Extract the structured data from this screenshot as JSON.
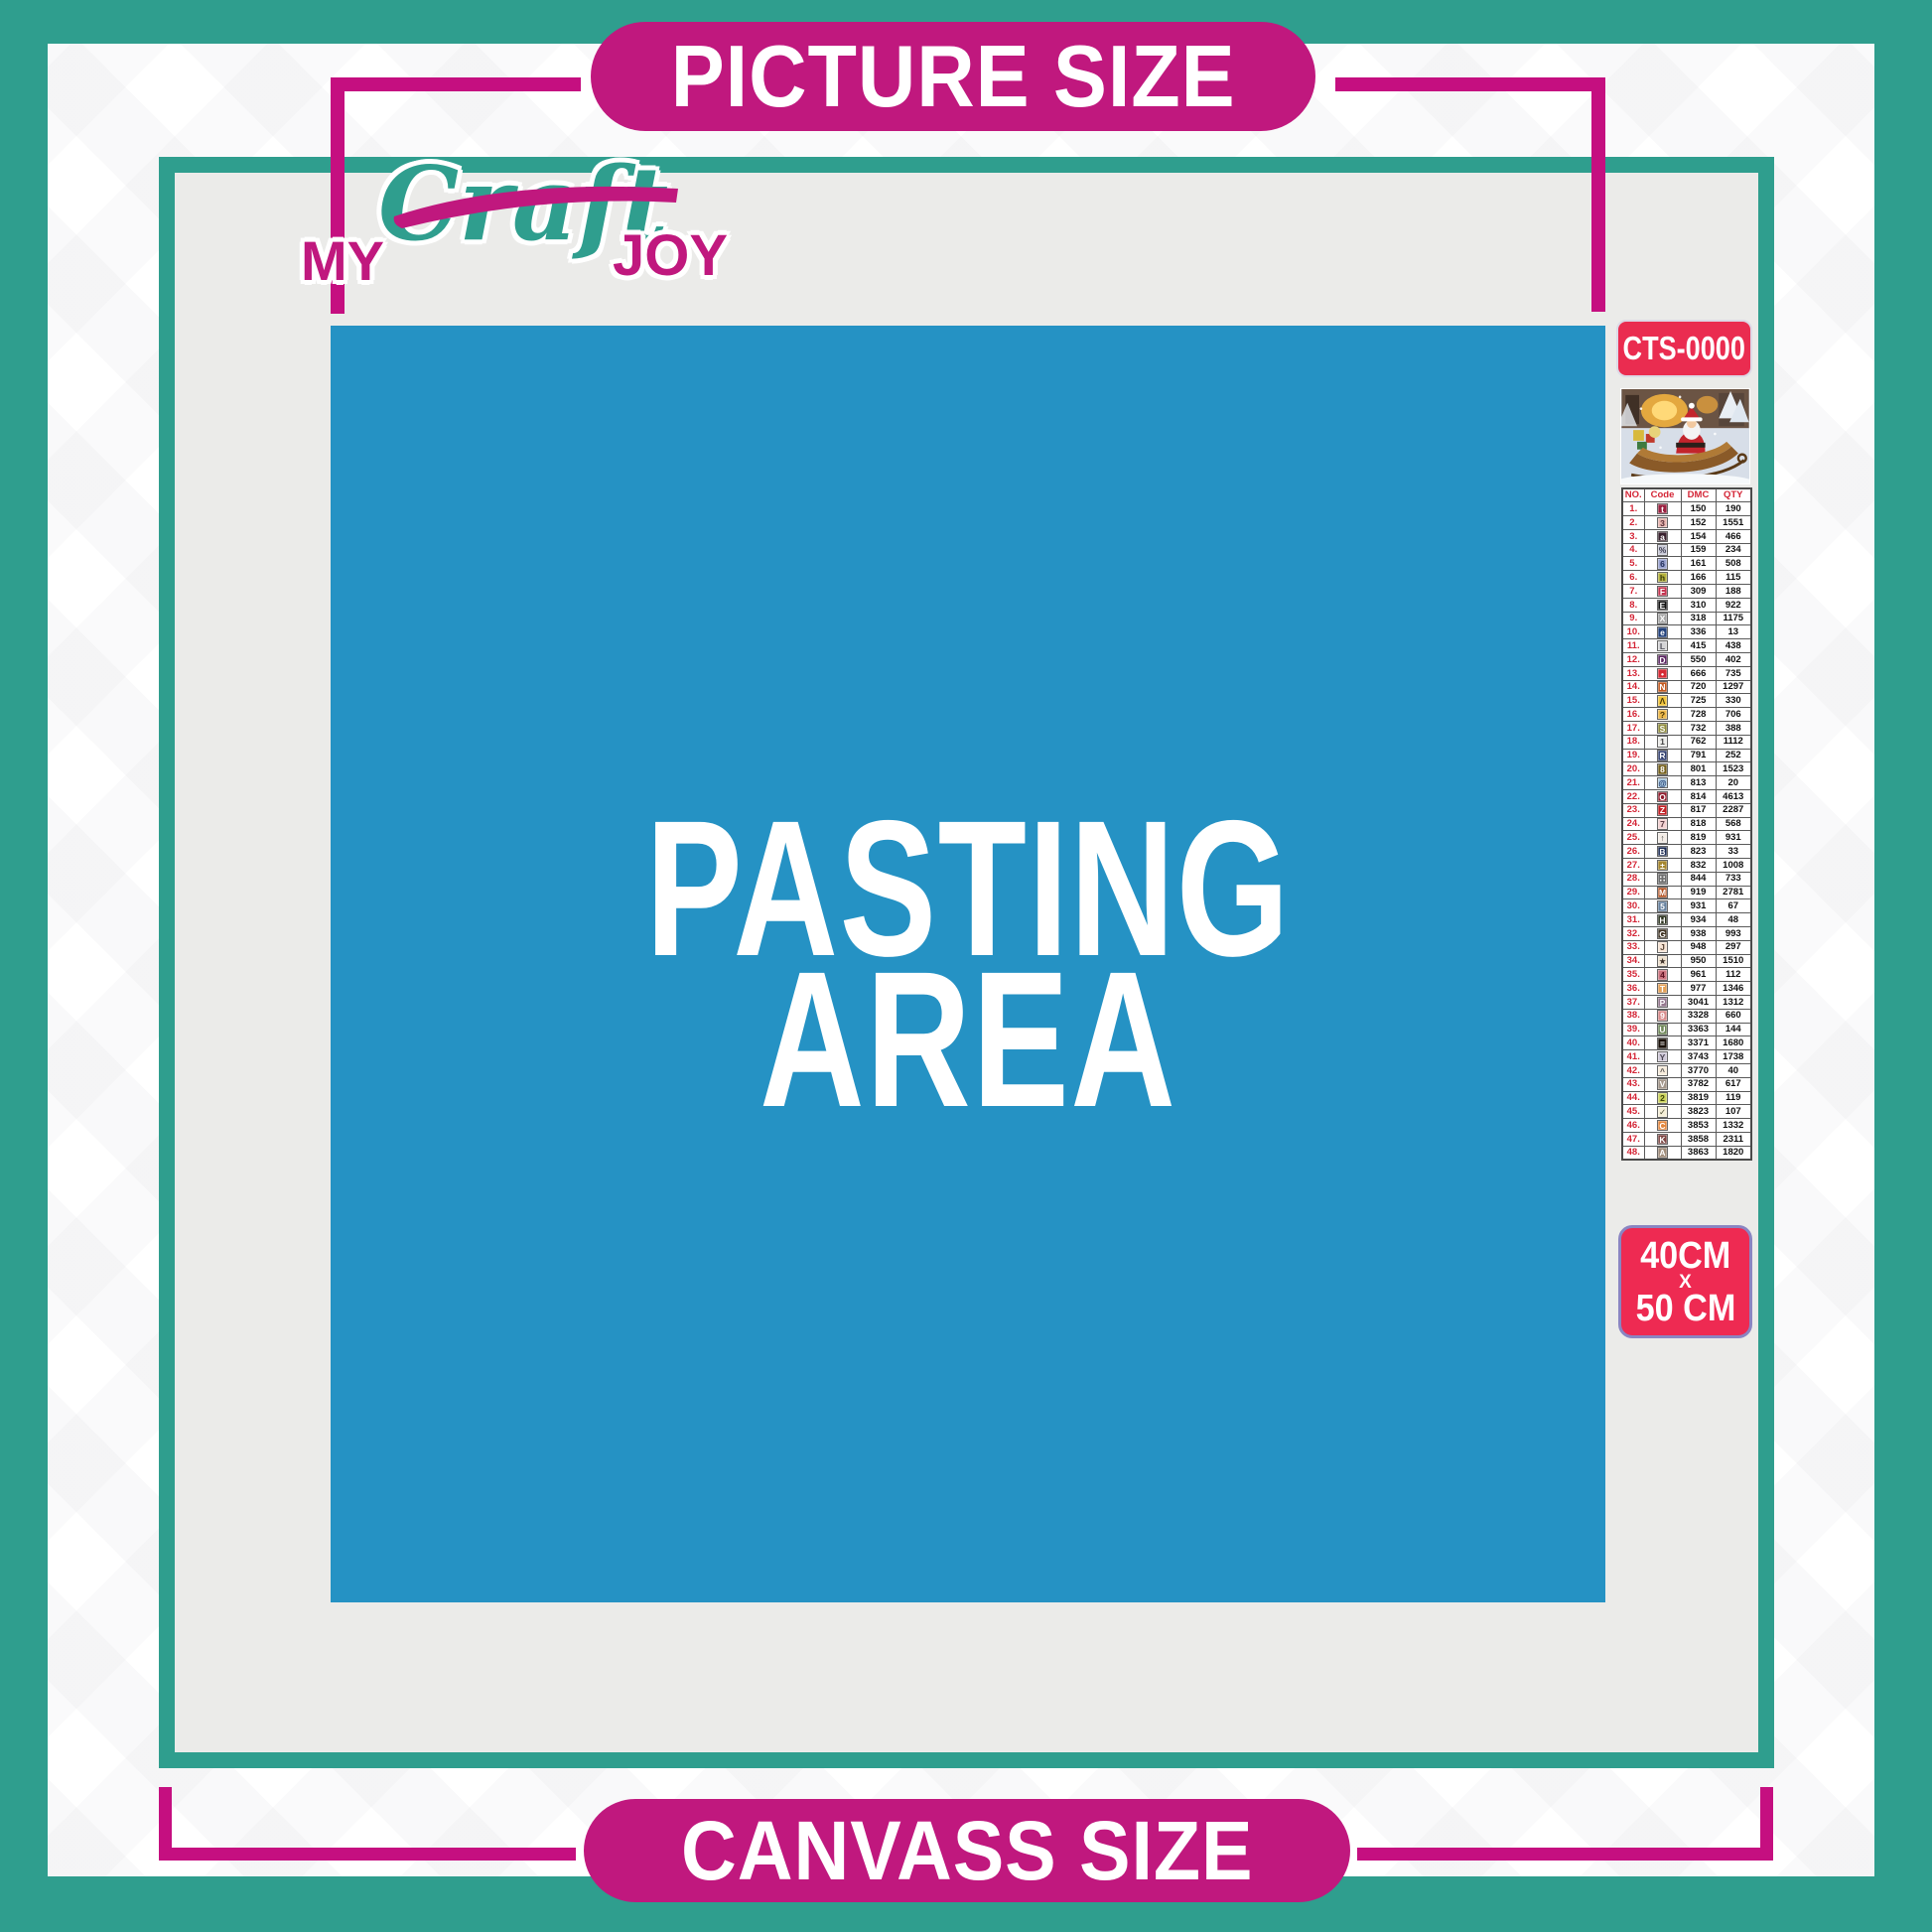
{
  "banners": {
    "top": "PICTURE SIZE",
    "bottom": "CANVASS SIZE"
  },
  "logo": {
    "word1": "MY",
    "word2": "Craft",
    "word3": "JOY"
  },
  "pasting_area": {
    "line1": "PASTING",
    "line2": "AREA"
  },
  "product": {
    "code": "CTS-0000",
    "thumbnail_alt": "Santa Claus riding a gift-filled sleigh in a snowy Christmas scene",
    "size_line1": "40CM",
    "size_line2": "X",
    "size_line3": "50 CM"
  },
  "colors": {
    "teal": "#2f9e8e",
    "magenta": "#c0187e",
    "blue": "#2592c4",
    "badge_red": "#ea2c50",
    "board_gray": "#ebebe9"
  },
  "color_table": {
    "headers": [
      "NO.",
      "Code",
      "DMC",
      "QTY"
    ],
    "rows": [
      {
        "no": "1.",
        "symbol": "t",
        "chip_bg": "#9a2140",
        "chip_fg": "#ffffff",
        "dmc": "150",
        "qty": "190"
      },
      {
        "no": "2.",
        "symbol": "3",
        "chip_bg": "#e7b5af",
        "chip_fg": "#5a3038",
        "dmc": "152",
        "qty": "1551"
      },
      {
        "no": "3.",
        "symbol": "a",
        "chip_bg": "#39212e",
        "chip_fg": "#ffffff",
        "dmc": "154",
        "qty": "466"
      },
      {
        "no": "4.",
        "symbol": "%",
        "chip_bg": "#c8c9d6",
        "chip_fg": "#3c3c50",
        "dmc": "159",
        "qty": "234"
      },
      {
        "no": "5.",
        "symbol": "6",
        "chip_bg": "#9aa3cf",
        "chip_fg": "#1e2a56",
        "dmc": "161",
        "qty": "508"
      },
      {
        "no": "6.",
        "symbol": "h",
        "chip_bg": "#b4b13c",
        "chip_fg": "#383a0e",
        "dmc": "166",
        "qty": "115"
      },
      {
        "no": "7.",
        "symbol": "F",
        "chip_bg": "#c43450",
        "chip_fg": "#ffffff",
        "dmc": "309",
        "qty": "188"
      },
      {
        "no": "8.",
        "symbol": "E",
        "chip_bg": "#111111",
        "chip_fg": "#ffffff",
        "dmc": "310",
        "qty": "922"
      },
      {
        "no": "9.",
        "symbol": "X",
        "chip_bg": "#a6a6a6",
        "chip_fg": "#ffffff",
        "dmc": "318",
        "qty": "1175"
      },
      {
        "no": "10.",
        "symbol": "e",
        "chip_bg": "#23427c",
        "chip_fg": "#ffffff",
        "dmc": "336",
        "qty": "13"
      },
      {
        "no": "11.",
        "symbol": "L",
        "chip_bg": "#d4d4d6",
        "chip_fg": "#55555f",
        "dmc": "415",
        "qty": "438"
      },
      {
        "no": "12.",
        "symbol": "D",
        "chip_bg": "#5a2460",
        "chip_fg": "#ffffff",
        "dmc": "550",
        "qty": "402"
      },
      {
        "no": "13.",
        "symbol": "•",
        "chip_bg": "#d62b35",
        "chip_fg": "#ffffff",
        "dmc": "666",
        "qty": "735"
      },
      {
        "no": "14.",
        "symbol": "N",
        "chip_bg": "#c2591f",
        "chip_fg": "#ffffff",
        "dmc": "720",
        "qty": "1297"
      },
      {
        "no": "15.",
        "symbol": "Λ",
        "chip_bg": "#f2c63f",
        "chip_fg": "#4a3a08",
        "dmc": "725",
        "qty": "330"
      },
      {
        "no": "16.",
        "symbol": "?",
        "chip_bg": "#ecb84b",
        "chip_fg": "#4a3508",
        "dmc": "728",
        "qty": "706"
      },
      {
        "no": "17.",
        "symbol": "S",
        "chip_bg": "#8f8b3c",
        "chip_fg": "#ffffff",
        "dmc": "732",
        "qty": "388"
      },
      {
        "no": "18.",
        "symbol": "1",
        "chip_bg": "#ededea",
        "chip_fg": "#444444",
        "dmc": "762",
        "qty": "1112"
      },
      {
        "no": "19.",
        "symbol": "R",
        "chip_bg": "#32406f",
        "chip_fg": "#ffffff",
        "dmc": "791",
        "qty": "252"
      },
      {
        "no": "20.",
        "symbol": "8",
        "chip_bg": "#75601c",
        "chip_fg": "#ffffff",
        "dmc": "801",
        "qty": "1523"
      },
      {
        "no": "21.",
        "symbol": "@",
        "chip_bg": "#a9c6dd",
        "chip_fg": "#1d3a6e",
        "dmc": "813",
        "qty": "20"
      },
      {
        "no": "22.",
        "symbol": "O",
        "chip_bg": "#8f1b2c",
        "chip_fg": "#ffffff",
        "dmc": "814",
        "qty": "4613"
      },
      {
        "no": "23.",
        "symbol": "Z",
        "chip_bg": "#c02025",
        "chip_fg": "#ffffff",
        "dmc": "817",
        "qty": "2287"
      },
      {
        "no": "24.",
        "symbol": "7",
        "chip_bg": "#f3d2d2",
        "chip_fg": "#5a3a42",
        "dmc": "818",
        "qty": "568"
      },
      {
        "no": "25.",
        "symbol": "↑",
        "chip_bg": "#f3ece6",
        "chip_fg": "#444444",
        "dmc": "819",
        "qty": "931"
      },
      {
        "no": "26.",
        "symbol": "B",
        "chip_bg": "#1b2a52",
        "chip_fg": "#ffffff",
        "dmc": "823",
        "qty": "33"
      },
      {
        "no": "27.",
        "symbol": "±",
        "chip_bg": "#a5862e",
        "chip_fg": "#ffffff",
        "dmc": "832",
        "qty": "1008"
      },
      {
        "no": "28.",
        "symbol": "∷",
        "chip_bg": "#6e6e6e",
        "chip_fg": "#ffffff",
        "dmc": "844",
        "qty": "733"
      },
      {
        "no": "29.",
        "symbol": "M",
        "chip_bg": "#b35222",
        "chip_fg": "#ffffff",
        "dmc": "919",
        "qty": "2781"
      },
      {
        "no": "30.",
        "symbol": "5",
        "chip_bg": "#68829f",
        "chip_fg": "#ffffff",
        "dmc": "931",
        "qty": "67"
      },
      {
        "no": "31.",
        "symbol": "H",
        "chip_bg": "#2c331f",
        "chip_fg": "#ffffff",
        "dmc": "934",
        "qty": "48"
      },
      {
        "no": "32.",
        "symbol": "G",
        "chip_bg": "#3e3222",
        "chip_fg": "#ffffff",
        "dmc": "938",
        "qty": "993"
      },
      {
        "no": "33.",
        "symbol": "J",
        "chip_bg": "#f6e3d4",
        "chip_fg": "#5a4636",
        "dmc": "948",
        "qty": "297"
      },
      {
        "no": "34.",
        "symbol": "★",
        "chip_bg": "#eee0ce",
        "chip_fg": "#3c3028",
        "dmc": "950",
        "qty": "1510"
      },
      {
        "no": "35.",
        "symbol": "4",
        "chip_bg": "#cc7580",
        "chip_fg": "#5c1020",
        "dmc": "961",
        "qty": "112"
      },
      {
        "no": "36.",
        "symbol": "T",
        "chip_bg": "#e2a057",
        "chip_fg": "#ffffff",
        "dmc": "977",
        "qty": "1346"
      },
      {
        "no": "37.",
        "symbol": "P",
        "chip_bg": "#95788f",
        "chip_fg": "#ffffff",
        "dmc": "3041",
        "qty": "1312"
      },
      {
        "no": "38.",
        "symbol": "9",
        "chip_bg": "#d88c8c",
        "chip_fg": "#ffffff",
        "dmc": "3328",
        "qty": "660"
      },
      {
        "no": "39.",
        "symbol": "U",
        "chip_bg": "#70885a",
        "chip_fg": "#ffffff",
        "dmc": "3363",
        "qty": "144"
      },
      {
        "no": "40.",
        "symbol": "=",
        "chip_bg": "#191009",
        "chip_fg": "#ffffff",
        "dmc": "3371",
        "qty": "1680"
      },
      {
        "no": "41.",
        "symbol": "Y",
        "chip_bg": "#cfc9d8",
        "chip_fg": "#4a4452",
        "dmc": "3743",
        "qty": "1738"
      },
      {
        "no": "42.",
        "symbol": "^",
        "chip_bg": "#f7ecdc",
        "chip_fg": "#555555",
        "dmc": "3770",
        "qty": "40"
      },
      {
        "no": "43.",
        "symbol": "V",
        "chip_bg": "#a3968a",
        "chip_fg": "#ffffff",
        "dmc": "3782",
        "qty": "617"
      },
      {
        "no": "44.",
        "symbol": "2",
        "chip_bg": "#ccd35e",
        "chip_fg": "#3c4208",
        "dmc": "3819",
        "qty": "119"
      },
      {
        "no": "45.",
        "symbol": "✓",
        "chip_bg": "#f5efd8",
        "chip_fg": "#4a4a30",
        "dmc": "3823",
        "qty": "107"
      },
      {
        "no": "46.",
        "symbol": "C",
        "chip_bg": "#e3873e",
        "chip_fg": "#ffffff",
        "dmc": "3853",
        "qty": "1332"
      },
      {
        "no": "47.",
        "symbol": "K",
        "chip_bg": "#7c4442",
        "chip_fg": "#ffffff",
        "dmc": "3858",
        "qty": "2311"
      },
      {
        "no": "48.",
        "symbol": "A",
        "chip_bg": "#a08c7a",
        "chip_fg": "#ffffff",
        "dmc": "3863",
        "qty": "1820"
      }
    ]
  }
}
